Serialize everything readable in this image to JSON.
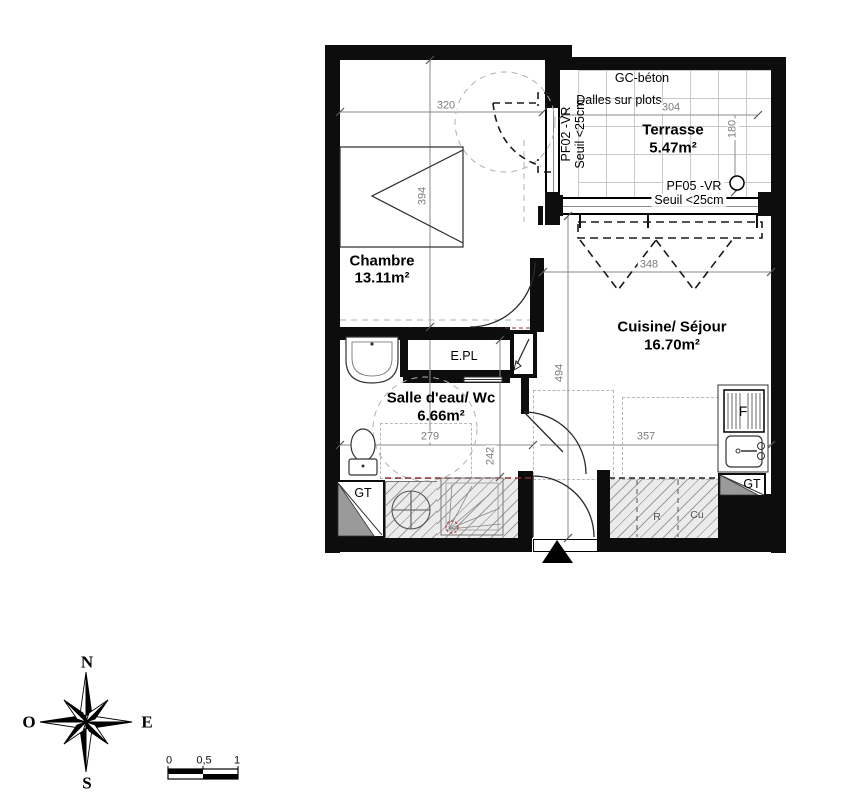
{
  "rooms": {
    "chambre": {
      "name": "Chambre",
      "area": "13.11m²"
    },
    "terrasse": {
      "name": "Terrasse",
      "area": "5.47m²"
    },
    "cuisine": {
      "name": "Cuisine/ Séjour",
      "area": "16.70m²"
    },
    "salle_eau": {
      "name": "Salle d'eau/ Wc",
      "area": "6.66m²"
    },
    "placard": {
      "name": "E.PL"
    }
  },
  "terrasse_notes": {
    "material": "GC-béton",
    "slabs": "Dalles sur plots"
  },
  "windows": {
    "pf02": {
      "code": "PF02 -VR",
      "seuil": "Seuil <25cm"
    },
    "pf05": {
      "code": "PF05 -VR",
      "seuil": "Seuil <25cm"
    }
  },
  "ducts": {
    "gt_left": "GT",
    "gt_right": "GT"
  },
  "kitchen": {
    "fridge": "F",
    "r": "R",
    "cu": "Cu"
  },
  "dims": {
    "chambre_width": "320",
    "chambre_height": "394",
    "terrasse_width": "304",
    "terrasse_height": "180",
    "cuisine_width": "348",
    "cuisine_height": "494",
    "sdb_width": "279",
    "hall_height": "242",
    "cuisine_lower_width": "357"
  },
  "compass": {
    "north": "N",
    "south": "S",
    "east": "E",
    "west": "O"
  },
  "scale_bar": {
    "zero": "0",
    "half": "0,5",
    "one": "1"
  }
}
